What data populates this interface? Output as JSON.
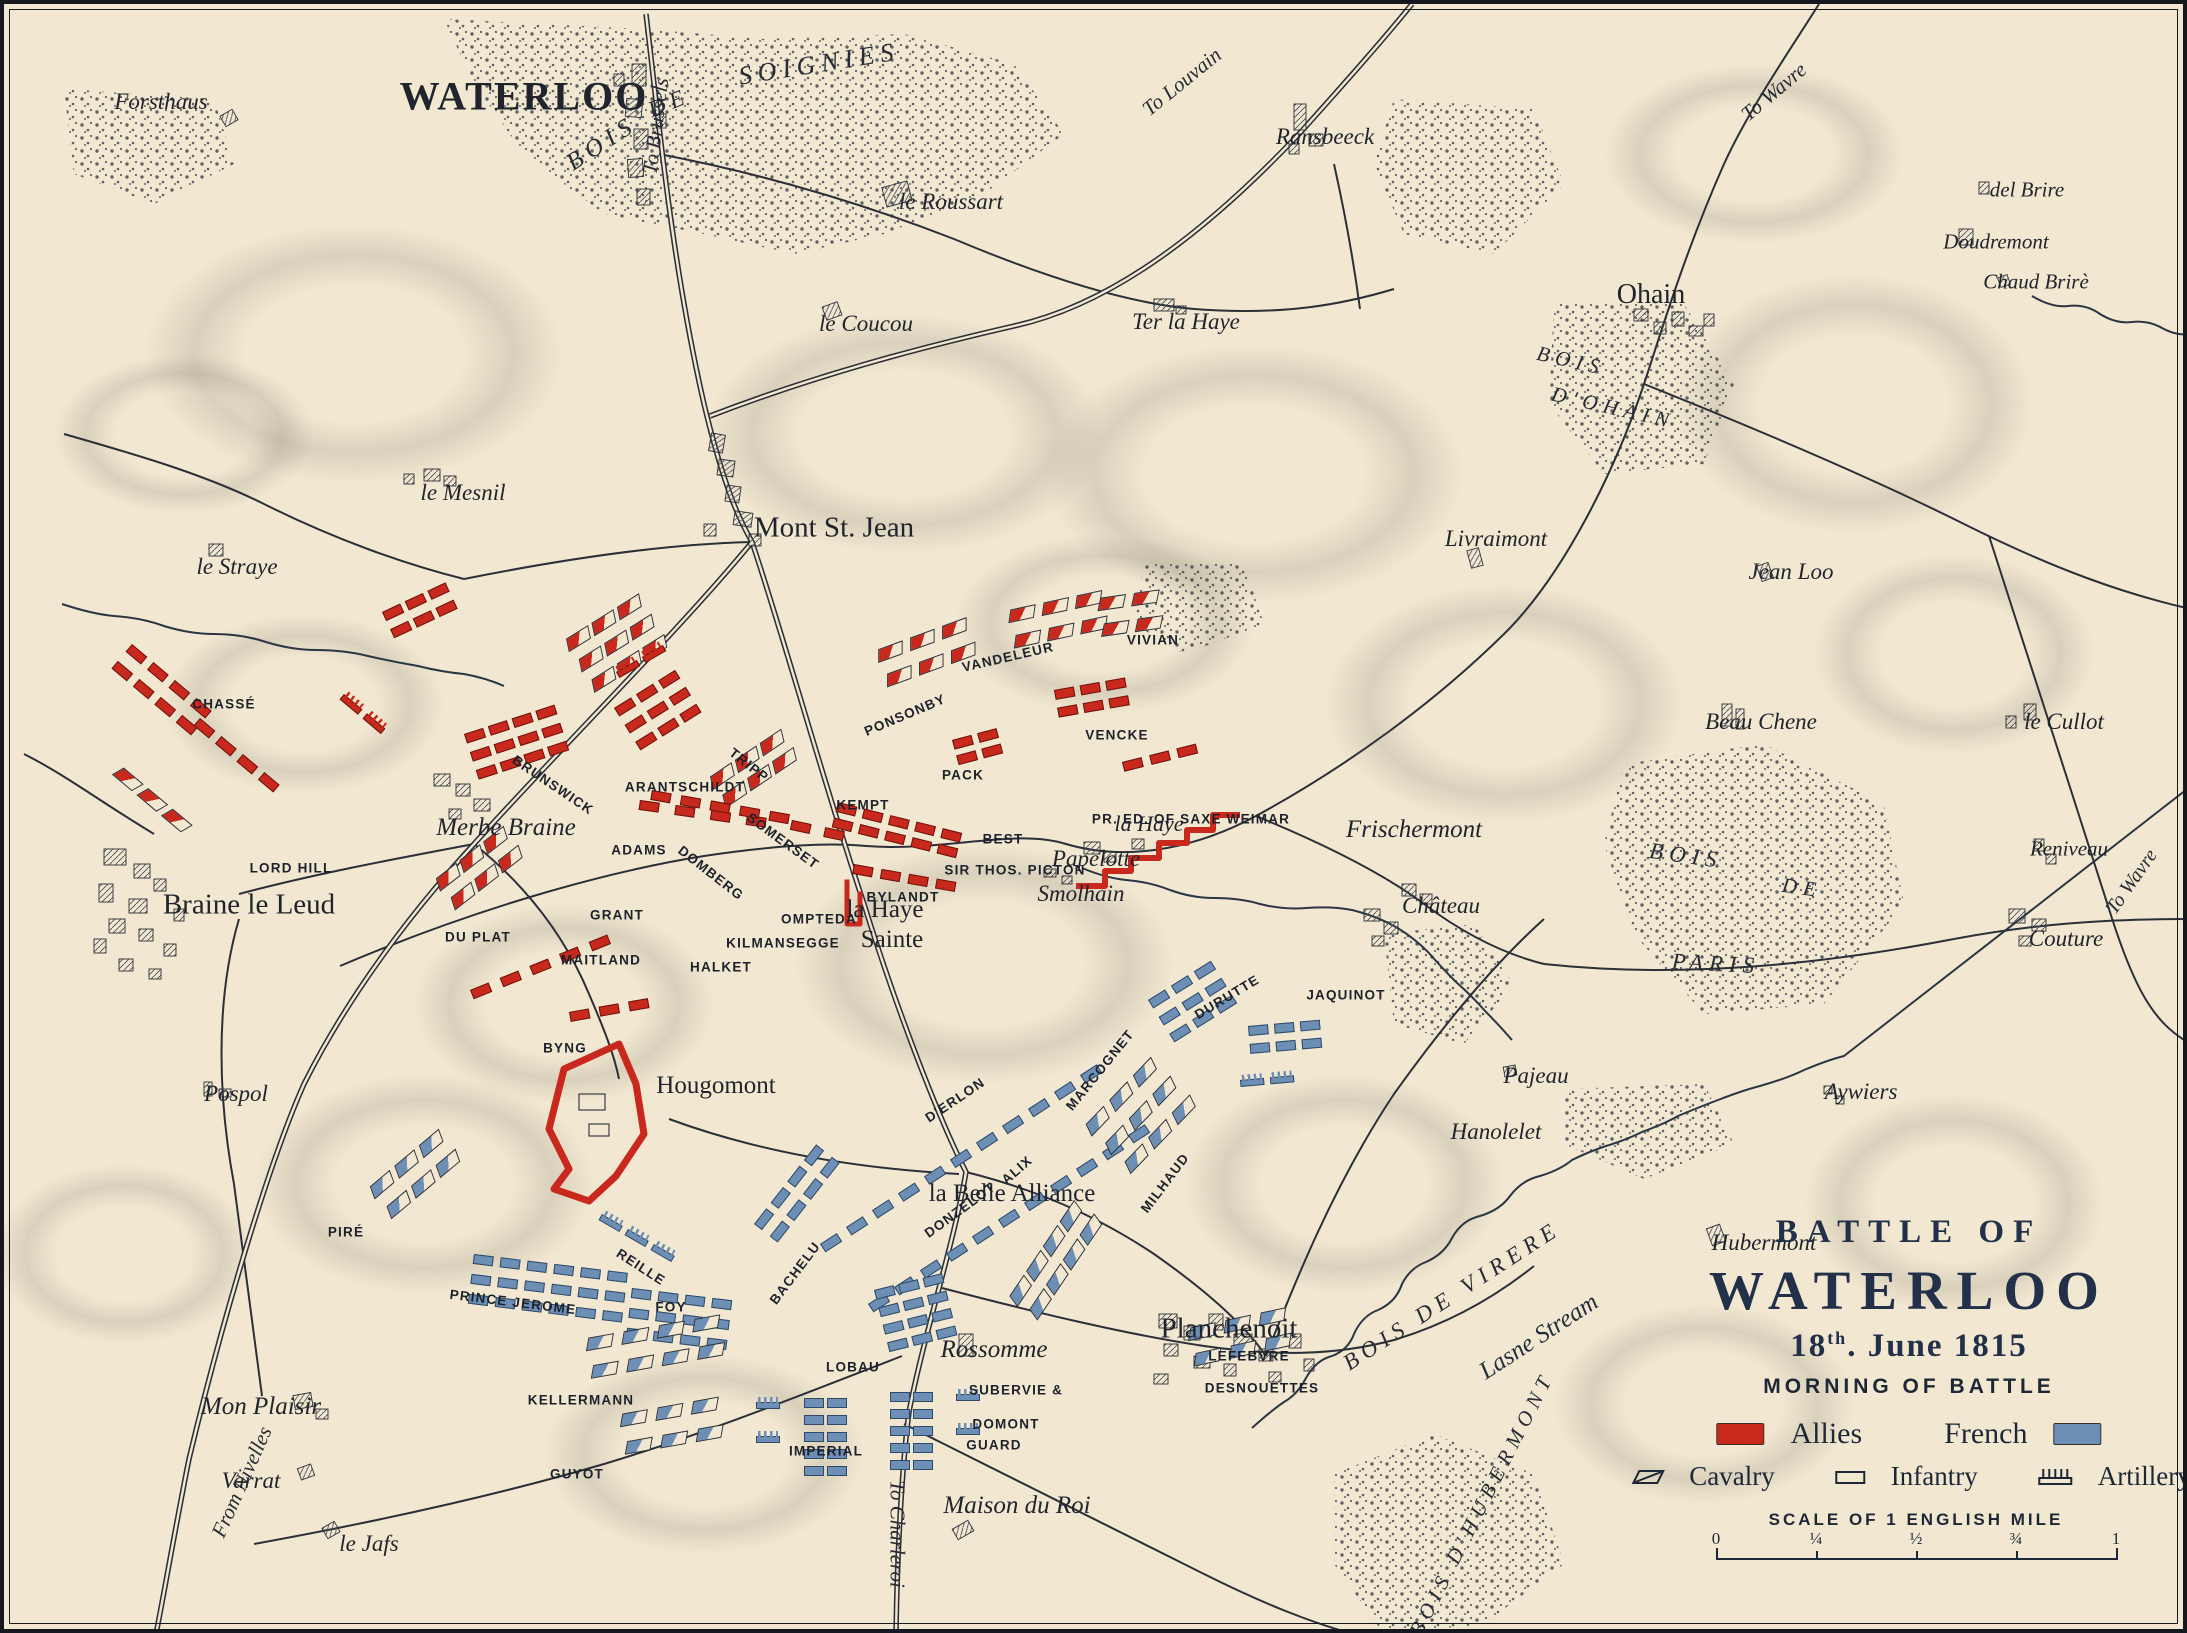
{
  "title": {
    "line1": "BATTLE OF",
    "line2": "WATERLOO",
    "date_num": "18",
    "date_sup": "th",
    "date_rest": ". June 1815",
    "subtitle": "MORNING OF BATTLE"
  },
  "legend": {
    "allies_label": "Allies",
    "french_label": "French",
    "allies_color": "#c9281c",
    "french_color": "#6d8fb6",
    "types": [
      {
        "name": "Cavalry"
      },
      {
        "name": "Infantry"
      },
      {
        "name": "Artillery"
      }
    ]
  },
  "scale": {
    "caption": "SCALE OF 1 ENGLISH MILE",
    "ticks": [
      "0",
      "¼",
      "½",
      "¾",
      "1"
    ]
  },
  "colors": {
    "paper": "#f2e8d2",
    "ink": "#2b2f38",
    "allies": "#c9281c",
    "french": "#6d8fb6",
    "water": "#2b3644"
  },
  "places": [
    {
      "t": "Forsthaus",
      "x": 157,
      "y": 98,
      "k": "i",
      "s": 23
    },
    {
      "t": "WATERLOO",
      "x": 520,
      "y": 92,
      "k": "T",
      "s": 40
    },
    {
      "t": "BOIS",
      "x": 598,
      "y": 140,
      "k": "a",
      "s": 25,
      "r": -33
    },
    {
      "t": "DE",
      "x": 665,
      "y": 99,
      "k": "a",
      "s": 23,
      "r": -22
    },
    {
      "t": "SOIGNIES",
      "x": 815,
      "y": 60,
      "k": "a",
      "s": 26,
      "r": -9
    },
    {
      "t": "To Brussels",
      "x": 652,
      "y": 122,
      "k": "r",
      "s": 21,
      "r": -83
    },
    {
      "t": "le Roussart",
      "x": 947,
      "y": 198,
      "k": "i",
      "s": 23
    },
    {
      "t": "le Coucou",
      "x": 862,
      "y": 320,
      "k": "i",
      "s": 23
    },
    {
      "t": "Ter la Haye",
      "x": 1182,
      "y": 318,
      "k": "i",
      "s": 23
    },
    {
      "t": "To Louvain",
      "x": 1178,
      "y": 78,
      "k": "r",
      "s": 21,
      "r": -39
    },
    {
      "t": "Ransbeeck",
      "x": 1321,
      "y": 133,
      "k": "i",
      "s": 23
    },
    {
      "t": "Ohain",
      "x": 1647,
      "y": 291,
      "k": "t",
      "s": 28
    },
    {
      "t": "BOIS",
      "x": 1567,
      "y": 357,
      "k": "a",
      "s": 21,
      "r": 13
    },
    {
      "t": "D'OHAIN",
      "x": 1609,
      "y": 404,
      "k": "a",
      "s": 21,
      "r": 13
    },
    {
      "t": "del Brire",
      "x": 2023,
      "y": 186,
      "k": "i",
      "s": 21
    },
    {
      "t": "Doudremont",
      "x": 1992,
      "y": 238,
      "k": "i",
      "s": 21
    },
    {
      "t": "Chaud Brirè",
      "x": 2032,
      "y": 278,
      "k": "i",
      "s": 21
    },
    {
      "t": "To Wavre",
      "x": 1770,
      "y": 88,
      "k": "r",
      "s": 21,
      "r": -40
    },
    {
      "t": "le Mesnil",
      "x": 459,
      "y": 489,
      "k": "i",
      "s": 23
    },
    {
      "t": "le Straye",
      "x": 233,
      "y": 563,
      "k": "i",
      "s": 23
    },
    {
      "t": "Mont St. Jean",
      "x": 830,
      "y": 524,
      "k": "t",
      "s": 29
    },
    {
      "t": "Livraimont",
      "x": 1492,
      "y": 535,
      "k": "i",
      "s": 23
    },
    {
      "t": "Jean Loo",
      "x": 1787,
      "y": 568,
      "k": "i",
      "s": 23
    },
    {
      "t": "Beau Chene",
      "x": 1757,
      "y": 718,
      "k": "i",
      "s": 23
    },
    {
      "t": "le Cullot",
      "x": 2060,
      "y": 718,
      "k": "i",
      "s": 23
    },
    {
      "t": "Reniveau",
      "x": 2065,
      "y": 845,
      "k": "i",
      "s": 21
    },
    {
      "t": "To Wavre",
      "x": 2128,
      "y": 878,
      "k": "r",
      "s": 20,
      "r": -55
    },
    {
      "t": "Couture",
      "x": 2062,
      "y": 935,
      "k": "i",
      "s": 23
    },
    {
      "t": "BOIS",
      "x": 1682,
      "y": 852,
      "k": "a",
      "s": 23,
      "r": 8
    },
    {
      "t": "DE",
      "x": 1798,
      "y": 884,
      "k": "a",
      "s": 21,
      "r": 8
    },
    {
      "t": "PARIS",
      "x": 1712,
      "y": 960,
      "k": "a",
      "s": 23,
      "r": 3
    },
    {
      "t": "Braine le Leud",
      "x": 245,
      "y": 901,
      "k": "t",
      "s": 29
    },
    {
      "t": "Merbe Braine",
      "x": 502,
      "y": 824,
      "k": "i",
      "s": 25
    },
    {
      "t": "la Haye",
      "x": 881,
      "y": 906,
      "k": "t",
      "s": 25
    },
    {
      "t": "Sainte",
      "x": 888,
      "y": 936,
      "k": "t",
      "s": 25
    },
    {
      "t": "Papelotte",
      "x": 1092,
      "y": 855,
      "k": "i",
      "s": 23
    },
    {
      "t": "Smolhain",
      "x": 1077,
      "y": 890,
      "k": "i",
      "s": 23
    },
    {
      "t": "la Haye",
      "x": 1145,
      "y": 820,
      "k": "i",
      "s": 22
    },
    {
      "t": "Frischermont",
      "x": 1410,
      "y": 826,
      "k": "i",
      "s": 25
    },
    {
      "t": "Château",
      "x": 1437,
      "y": 902,
      "k": "i",
      "s": 23
    },
    {
      "t": "Pospol",
      "x": 232,
      "y": 1090,
      "k": "i",
      "s": 23
    },
    {
      "t": "Hougomont",
      "x": 712,
      "y": 1082,
      "k": "t",
      "s": 25
    },
    {
      "t": "Pajeau",
      "x": 1532,
      "y": 1072,
      "k": "i",
      "s": 23
    },
    {
      "t": "Hanolelet",
      "x": 1492,
      "y": 1128,
      "k": "i",
      "s": 23
    },
    {
      "t": "Aywiers",
      "x": 1857,
      "y": 1088,
      "k": "i",
      "s": 23
    },
    {
      "t": "Hubermont",
      "x": 1760,
      "y": 1239,
      "k": "i",
      "s": 23
    },
    {
      "t": "Mon Plaisir",
      "x": 257,
      "y": 1403,
      "k": "i",
      "s": 25
    },
    {
      "t": "Varrat",
      "x": 247,
      "y": 1477,
      "k": "i",
      "s": 23
    },
    {
      "t": "le Jafs",
      "x": 365,
      "y": 1540,
      "k": "i",
      "s": 23
    },
    {
      "t": "From Nivelles",
      "x": 238,
      "y": 1478,
      "k": "r",
      "s": 21,
      "r": -66
    },
    {
      "t": "To Charleroi",
      "x": 893,
      "y": 1530,
      "k": "r",
      "s": 21,
      "r": 90
    },
    {
      "t": "Rossomme",
      "x": 990,
      "y": 1346,
      "k": "i",
      "s": 25
    },
    {
      "t": "Maison du Roi",
      "x": 1013,
      "y": 1502,
      "k": "i",
      "s": 25
    },
    {
      "t": "Planchenoit",
      "x": 1225,
      "y": 1325,
      "k": "t",
      "s": 29
    },
    {
      "t": "la Belle Alliance",
      "x": 1008,
      "y": 1190,
      "k": "t",
      "s": 25
    },
    {
      "t": "BOIS DE VIRERE",
      "x": 1448,
      "y": 1292,
      "k": "a",
      "s": 23,
      "r": -33
    },
    {
      "t": "Lasne Stream",
      "x": 1535,
      "y": 1333,
      "k": "w",
      "s": 25,
      "r": -33
    },
    {
      "t": "BOIS D'HUBERMONT",
      "x": 1478,
      "y": 1500,
      "k": "a",
      "s": 21,
      "r": -63
    }
  ],
  "troop_labels": [
    {
      "t": "CHASSÉ",
      "x": 220,
      "y": 700,
      "sd": "a"
    },
    {
      "t": "LORD HILL",
      "x": 287,
      "y": 864,
      "sd": "a"
    },
    {
      "t": "DU PLAT",
      "x": 474,
      "y": 933,
      "sd": "a"
    },
    {
      "t": "GRANT",
      "x": 613,
      "y": 911,
      "sd": "a"
    },
    {
      "t": "MAITLAND",
      "x": 597,
      "y": 956,
      "sd": "a"
    },
    {
      "t": "BYNG",
      "x": 561,
      "y": 1044,
      "sd": "a"
    },
    {
      "t": "BRUNSWICK",
      "x": 549,
      "y": 781,
      "sd": "a",
      "r": 34
    },
    {
      "t": "ADAMS",
      "x": 635,
      "y": 846,
      "sd": "a"
    },
    {
      "t": "DOMBERG",
      "x": 707,
      "y": 869,
      "sd": "a",
      "r": 38
    },
    {
      "t": "SOMERSET",
      "x": 779,
      "y": 837,
      "sd": "a",
      "r": 36
    },
    {
      "t": "ARANTSCHILDT",
      "x": 681,
      "y": 783,
      "sd": "a"
    },
    {
      "t": "TRIPP",
      "x": 745,
      "y": 761,
      "sd": "a",
      "r": 38
    },
    {
      "t": "KILMANSEGGE",
      "x": 779,
      "y": 939,
      "sd": "a"
    },
    {
      "t": "OMPTEDA",
      "x": 815,
      "y": 915,
      "sd": "a"
    },
    {
      "t": "HALKET",
      "x": 717,
      "y": 963,
      "sd": "a"
    },
    {
      "t": "KEMPT",
      "x": 859,
      "y": 801,
      "sd": "a"
    },
    {
      "t": "PACK",
      "x": 959,
      "y": 771,
      "sd": "a"
    },
    {
      "t": "BEST",
      "x": 999,
      "y": 835,
      "sd": "a"
    },
    {
      "t": "SIR THOS. PICTON",
      "x": 1011,
      "y": 866,
      "sd": "a"
    },
    {
      "t": "BYLANDT",
      "x": 899,
      "y": 893,
      "sd": "a"
    },
    {
      "t": "PONSONBY",
      "x": 901,
      "y": 711,
      "sd": "a",
      "r": -23
    },
    {
      "t": "VANDELEUR",
      "x": 1004,
      "y": 653,
      "sd": "a",
      "r": -13
    },
    {
      "t": "VIVIAN",
      "x": 1149,
      "y": 636,
      "sd": "a"
    },
    {
      "t": "VENCKE",
      "x": 1113,
      "y": 731,
      "sd": "a"
    },
    {
      "t": "PR. ED. OF SAXE WEIMAR",
      "x": 1187,
      "y": 815,
      "sd": "a"
    },
    {
      "t": "PIRÉ",
      "x": 342,
      "y": 1228,
      "sd": "f"
    },
    {
      "t": "PRINCE JEROME",
      "x": 509,
      "y": 1298,
      "sd": "f",
      "r": 7
    },
    {
      "t": "KELLERMANN",
      "x": 577,
      "y": 1396,
      "sd": "f"
    },
    {
      "t": "GUYOT",
      "x": 573,
      "y": 1470,
      "sd": "f"
    },
    {
      "t": "REILLE",
      "x": 637,
      "y": 1263,
      "sd": "f",
      "r": 33
    },
    {
      "t": "FOY",
      "x": 667,
      "y": 1303,
      "sd": "f"
    },
    {
      "t": "BACHELU",
      "x": 791,
      "y": 1269,
      "sd": "f",
      "r": -53
    },
    {
      "t": "LOBAU",
      "x": 849,
      "y": 1363,
      "sd": "f"
    },
    {
      "t": "IMPERIAL",
      "x": 822,
      "y": 1447,
      "sd": "f"
    },
    {
      "t": "GUARD",
      "x": 990,
      "y": 1441,
      "sd": "f"
    },
    {
      "t": "SUBERVIE &",
      "x": 1012,
      "y": 1386,
      "sd": "f"
    },
    {
      "t": "DOMONT",
      "x": 1002,
      "y": 1420,
      "sd": "f"
    },
    {
      "t": "LEFEBVRE",
      "x": 1245,
      "y": 1352,
      "sd": "f"
    },
    {
      "t": "DESNOUETTES",
      "x": 1258,
      "y": 1384,
      "sd": "f"
    },
    {
      "t": "D'ERLON",
      "x": 951,
      "y": 1096,
      "sd": "f",
      "r": -34
    },
    {
      "t": "DONZELOT",
      "x": 956,
      "y": 1206,
      "sd": "f",
      "r": -36
    },
    {
      "t": "ALIX",
      "x": 1013,
      "y": 1166,
      "sd": "f",
      "r": -41
    },
    {
      "t": "MARCOGNET",
      "x": 1096,
      "y": 1066,
      "sd": "f",
      "r": -51
    },
    {
      "t": "DURUTTE",
      "x": 1223,
      "y": 993,
      "sd": "f",
      "r": -31
    },
    {
      "t": "MILHAUD",
      "x": 1161,
      "y": 1179,
      "sd": "f",
      "r": -53
    },
    {
      "t": "JAQUINOT",
      "x": 1342,
      "y": 991,
      "sd": "f"
    }
  ],
  "unit_groups": [
    {
      "n": "chasse-1",
      "sd": "a",
      "ty": "inf",
      "x": 128,
      "y": 640,
      "r": 40,
      "rw": 2,
      "cl": 4,
      "dx": 28,
      "dy": 22
    },
    {
      "n": "chasse-2",
      "sd": "a",
      "ty": "inf",
      "x": 196,
      "y": 714,
      "r": 40,
      "rw": 1,
      "cl": 4,
      "dx": 28,
      "dy": 22
    },
    {
      "n": "chasse-3",
      "sd": "a",
      "ty": "cav",
      "x": 118,
      "y": 762,
      "r": 40,
      "rw": 1,
      "cl": 3,
      "dx": 32,
      "dy": 24
    },
    {
      "n": "chasse-guns",
      "sd": "a",
      "ty": "art",
      "x": 340,
      "y": 690,
      "r": 40,
      "rw": 1,
      "cl": 2,
      "dx": 30,
      "dy": 22
    },
    {
      "n": "upper-red",
      "sd": "a",
      "ty": "inf",
      "x": 378,
      "y": 608,
      "r": -25,
      "rw": 2,
      "cl": 3,
      "dx": 25,
      "dy": 19
    },
    {
      "n": "lordhill-1",
      "sd": "a",
      "ty": "inf",
      "x": 636,
      "y": 796,
      "r": 8,
      "rw": 1,
      "cl": 4,
      "dx": 36,
      "dy": 20
    },
    {
      "n": "lordhill-2",
      "sd": "a",
      "ty": "inf",
      "x": 788,
      "y": 816,
      "r": 12,
      "rw": 1,
      "cl": 2,
      "dx": 34,
      "dy": 20
    },
    {
      "n": "duplat",
      "sd": "a",
      "ty": "cav",
      "x": 430,
      "y": 876,
      "r": -38,
      "rw": 2,
      "cl": 3,
      "dx": 30,
      "dy": 24
    },
    {
      "n": "maitland",
      "sd": "a",
      "ty": "inf",
      "x": 466,
      "y": 986,
      "r": -22,
      "rw": 1,
      "cl": 5,
      "dx": 32,
      "dy": 20
    },
    {
      "n": "byng",
      "sd": "a",
      "ty": "inf",
      "x": 565,
      "y": 1008,
      "r": -10,
      "rw": 1,
      "cl": 3,
      "dx": 30,
      "dy": 20
    },
    {
      "n": "brunswick",
      "sd": "a",
      "ty": "inf",
      "x": 460,
      "y": 730,
      "r": -18,
      "rw": 3,
      "cl": 4,
      "dx": 25,
      "dy": 19
    },
    {
      "n": "tripp",
      "sd": "a",
      "ty": "cav",
      "x": 560,
      "y": 636,
      "r": -32,
      "rw": 3,
      "cl": 3,
      "dx": 30,
      "dy": 24
    },
    {
      "n": "arantschildt",
      "sd": "a",
      "ty": "inf",
      "x": 610,
      "y": 704,
      "r": -32,
      "rw": 3,
      "cl": 3,
      "dx": 26,
      "dy": 20
    },
    {
      "n": "somerset",
      "sd": "a",
      "ty": "cav",
      "x": 704,
      "y": 774,
      "r": -34,
      "rw": 2,
      "cl": 3,
      "dx": 30,
      "dy": 22
    },
    {
      "n": "front-west",
      "sd": "a",
      "ty": "inf",
      "x": 648,
      "y": 786,
      "r": 10,
      "rw": 1,
      "cl": 5,
      "dx": 30,
      "dy": 18
    },
    {
      "n": "picton",
      "sd": "a",
      "ty": "inf",
      "x": 834,
      "y": 798,
      "r": 14,
      "rw": 2,
      "cl": 5,
      "dx": 27,
      "dy": 16
    },
    {
      "n": "bylandt",
      "sd": "a",
      "ty": "inf",
      "x": 850,
      "y": 860,
      "r": 10,
      "rw": 1,
      "cl": 4,
      "dx": 28,
      "dy": 18
    },
    {
      "n": "ponsonby",
      "sd": "a",
      "ty": "cav",
      "x": 872,
      "y": 646,
      "r": -20,
      "rw": 2,
      "cl": 3,
      "dx": 34,
      "dy": 26
    },
    {
      "n": "vandeleur",
      "sd": "a",
      "ty": "cav",
      "x": 1004,
      "y": 606,
      "r": -12,
      "rw": 2,
      "cl": 3,
      "dx": 34,
      "dy": 26
    },
    {
      "n": "vivian",
      "sd": "a",
      "ty": "cav",
      "x": 1094,
      "y": 594,
      "r": -8,
      "rw": 2,
      "cl": 2,
      "dx": 34,
      "dy": 26
    },
    {
      "n": "vencke",
      "sd": "a",
      "ty": "inf",
      "x": 1050,
      "y": 686,
      "r": -10,
      "rw": 2,
      "cl": 3,
      "dx": 26,
      "dy": 18
    },
    {
      "n": "pack",
      "sd": "a",
      "ty": "inf",
      "x": 948,
      "y": 736,
      "r": -15,
      "rw": 2,
      "cl": 2,
      "dx": 26,
      "dy": 16
    },
    {
      "n": "saxe-weimar",
      "sd": "a",
      "ty": "inf",
      "x": 1118,
      "y": 758,
      "r": -14,
      "rw": 1,
      "cl": 3,
      "dx": 28,
      "dy": 18
    },
    {
      "n": "main-guns",
      "sd": "a",
      "ty": "art",
      "x": 612,
      "y": 668,
      "r": -30,
      "rw": 1,
      "cl": 2,
      "dx": 30,
      "dy": 20
    },
    {
      "n": "pire",
      "sd": "f",
      "ty": "cav",
      "x": 364,
      "y": 1184,
      "r": -40,
      "rw": 2,
      "cl": 3,
      "dx": 32,
      "dy": 26
    },
    {
      "n": "jerome",
      "sd": "f",
      "ty": "inf",
      "x": 470,
      "y": 1250,
      "r": 7,
      "rw": 3,
      "cl": 6,
      "dx": 27,
      "dy": 20
    },
    {
      "n": "foy",
      "sd": "f",
      "ty": "inf",
      "x": 628,
      "y": 1284,
      "r": 7,
      "rw": 3,
      "cl": 4,
      "dx": 27,
      "dy": 20
    },
    {
      "n": "bachelu",
      "sd": "f",
      "ty": "inf",
      "x": 750,
      "y": 1220,
      "r": -52,
      "rw": 2,
      "cl": 4,
      "dx": 27,
      "dy": 20
    },
    {
      "n": "reille-guns",
      "sd": "f",
      "ty": "art",
      "x": 598,
      "y": 1210,
      "r": 30,
      "rw": 1,
      "cl": 3,
      "dx": 30,
      "dy": 20
    },
    {
      "n": "kellermann",
      "sd": "f",
      "ty": "cav",
      "x": 582,
      "y": 1334,
      "r": -10,
      "rw": 2,
      "cl": 4,
      "dx": 36,
      "dy": 28
    },
    {
      "n": "guyot",
      "sd": "f",
      "ty": "cav",
      "x": 616,
      "y": 1410,
      "r": -10,
      "rw": 2,
      "cl": 3,
      "dx": 36,
      "dy": 28
    },
    {
      "n": "derlon-1",
      "sd": "f",
      "ty": "inf",
      "x": 816,
      "y": 1240,
      "r": -33,
      "rw": 1,
      "cl": 11,
      "dx": 31,
      "dy": 20
    },
    {
      "n": "derlon-2",
      "sd": "f",
      "ty": "inf",
      "x": 864,
      "y": 1300,
      "r": -33,
      "rw": 1,
      "cl": 11,
      "dx": 31,
      "dy": 20
    },
    {
      "n": "durutte",
      "sd": "f",
      "ty": "inf",
      "x": 1144,
      "y": 996,
      "r": -32,
      "rw": 3,
      "cl": 3,
      "dx": 27,
      "dy": 20
    },
    {
      "n": "milhaud",
      "sd": "f",
      "ty": "cav",
      "x": 1080,
      "y": 1122,
      "r": -46,
      "rw": 3,
      "cl": 3,
      "dx": 34,
      "dy": 27
    },
    {
      "n": "lobau",
      "sd": "f",
      "ty": "inf",
      "x": 870,
      "y": 1286,
      "r": -14,
      "rw": 4,
      "cl": 3,
      "dx": 25,
      "dy": 18
    },
    {
      "n": "guard-1",
      "sd": "f",
      "ty": "inf",
      "x": 800,
      "y": 1394,
      "r": 0,
      "rw": 5,
      "cl": 2,
      "dx": 23,
      "dy": 17
    },
    {
      "n": "guard-2",
      "sd": "f",
      "ty": "inf",
      "x": 886,
      "y": 1388,
      "r": 0,
      "rw": 5,
      "cl": 2,
      "dx": 23,
      "dy": 17
    },
    {
      "n": "guard-guns-l",
      "sd": "f",
      "ty": "art",
      "x": 752,
      "y": 1398,
      "r": 0,
      "rw": 2,
      "cl": 1,
      "dx": 26,
      "dy": 34
    },
    {
      "n": "guard-guns-r",
      "sd": "f",
      "ty": "art",
      "x": 952,
      "y": 1390,
      "r": 0,
      "rw": 2,
      "cl": 1,
      "dx": 26,
      "dy": 34
    },
    {
      "n": "subervie",
      "sd": "f",
      "ty": "cav",
      "x": 1004,
      "y": 1294,
      "r": -56,
      "rw": 2,
      "cl": 4,
      "dx": 30,
      "dy": 24
    },
    {
      "n": "lefebvre",
      "sd": "f",
      "ty": "cav",
      "x": 1184,
      "y": 1324,
      "r": -12,
      "rw": 2,
      "cl": 3,
      "dx": 36,
      "dy": 26
    },
    {
      "n": "jaquinot",
      "sd": "f",
      "ty": "inf",
      "x": 1244,
      "y": 1022,
      "r": -5,
      "rw": 2,
      "cl": 3,
      "dx": 26,
      "dy": 18
    },
    {
      "n": "jaquinot-guns",
      "sd": "f",
      "ty": "art",
      "x": 1236,
      "y": 1076,
      "r": -5,
      "rw": 1,
      "cl": 2,
      "dx": 30,
      "dy": 20
    }
  ]
}
